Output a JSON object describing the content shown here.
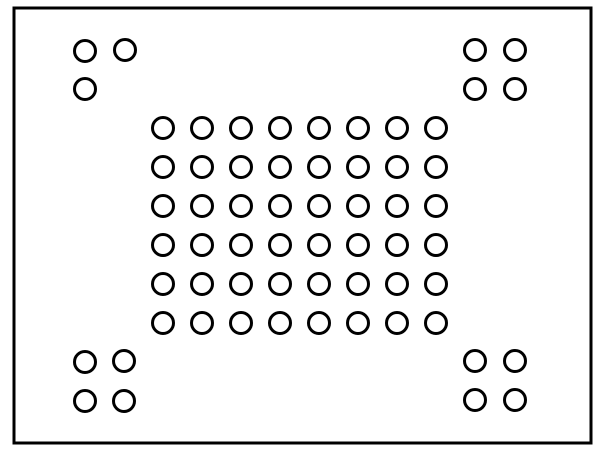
{
  "canvas": {
    "width": 600,
    "height": 452,
    "background": "#ffffff"
  },
  "colors": {
    "line": "#000000",
    "fill": "#ffffff"
  },
  "package_outline": {
    "x": 14,
    "y": 8,
    "width": 577,
    "height": 435,
    "stroke_width": 3
  },
  "ball_style": {
    "outer_diameter": 24,
    "stroke_width": 3
  },
  "center_grid": {
    "columns": 8,
    "rows": 6,
    "origin_x": 163,
    "origin_y": 128,
    "pitch_x": 39,
    "pitch_y": 39,
    "ball_count": 48
  },
  "corner_clusters": [
    {
      "name": "top-left",
      "ball_count": 3,
      "balls": [
        [
          85,
          51
        ],
        [
          125,
          50
        ],
        [
          85,
          89
        ]
      ]
    },
    {
      "name": "top-right",
      "ball_count": 4,
      "balls": [
        [
          475,
          50
        ],
        [
          515,
          50
        ],
        [
          475,
          89
        ],
        [
          515,
          89
        ]
      ]
    },
    {
      "name": "bottom-left",
      "ball_count": 4,
      "balls": [
        [
          85,
          362
        ],
        [
          124,
          361
        ],
        [
          85,
          401
        ],
        [
          124,
          401
        ]
      ]
    },
    {
      "name": "bottom-right",
      "ball_count": 4,
      "balls": [
        [
          475,
          361
        ],
        [
          515,
          361
        ],
        [
          475,
          400
        ],
        [
          515,
          400
        ]
      ]
    }
  ],
  "total_ball_count": 63
}
